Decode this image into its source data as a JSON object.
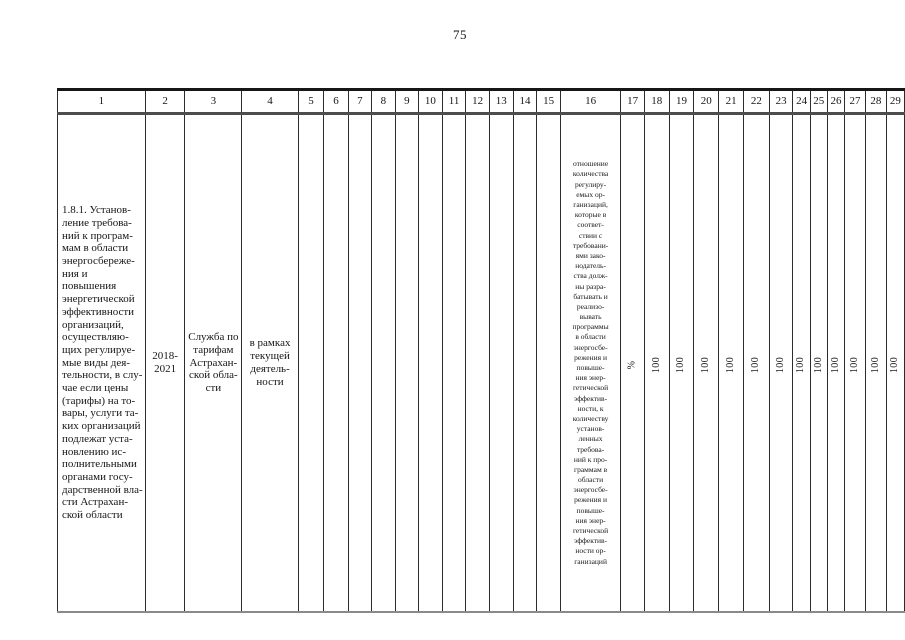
{
  "page": {
    "number": "75"
  },
  "table": {
    "header": [
      "1",
      "2",
      "3",
      "4",
      "5",
      "6",
      "7",
      "8",
      "9",
      "10",
      "11",
      "12",
      "13",
      "14",
      "15",
      "16",
      "17",
      "18",
      "19",
      "20",
      "21",
      "22",
      "23",
      "24",
      "25",
      "26",
      "27",
      "28",
      "29"
    ],
    "row": {
      "activity": [
        "1.8.1. Установ-",
        "ление требова-",
        "ний к програм-",
        "мам в области",
        "энергосбереже-",
        "ния и повышения",
        "энергетической",
        "эффективности",
        "организаций,",
        "осуществляю-",
        "щих регулируе-",
        "мые виды дея-",
        "тельности, в слу-",
        "чае если цены",
        "(тарифы) на то-",
        "вары, услуги та-",
        "ких организаций",
        "подлежат уста-",
        "новлению ис-",
        "полнительными",
        "органами госу-",
        "дарственной вла-",
        "сти Астрахан-",
        "ской области"
      ],
      "period": [
        "2018-",
        "2021"
      ],
      "executor": [
        "Служба по",
        "тарифам",
        "Астрахан-",
        "ской обла-",
        "сти"
      ],
      "funding": [
        "в рамках",
        "текущей",
        "деятель-",
        "ности"
      ],
      "indicator": [
        "отношение",
        "количества",
        "регулиру-",
        "емых ор-",
        "ганизаций,",
        "которые в",
        "соответ-",
        "ствии с",
        "требовани-",
        "ями зако-",
        "нодатель-",
        "ства долж-",
        "ны разра-",
        "батывать и",
        "реализо-",
        "вывать",
        "программы",
        "в области",
        "энергосбе-",
        "режения и",
        "повыше-",
        "ния энер-",
        "гетической",
        "эффектив-",
        "ности, к",
        "количеству",
        "установ-",
        "ленных",
        "требова-",
        "ний к про-",
        "граммам в",
        "области",
        "энергосбе-",
        "режения и",
        "повыше-",
        "ния энер-",
        "гетической",
        "эффектив-",
        "ности ор-",
        "ганизаций"
      ],
      "unit": "%",
      "values": [
        "100",
        "100",
        "100",
        "100",
        "100",
        "100",
        "100",
        "100",
        "100",
        "100",
        "100",
        "100"
      ]
    }
  }
}
